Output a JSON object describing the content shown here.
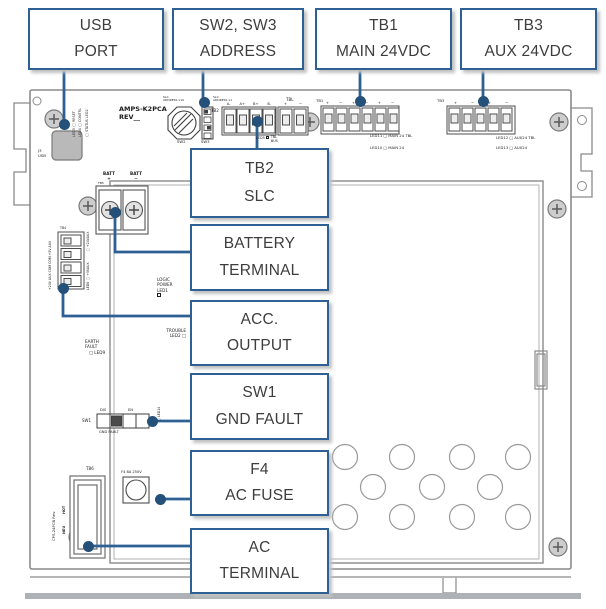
{
  "colors": {
    "accent": "#2E6094",
    "leader_dot": "#24507A",
    "line_gray": "#8A8A8A",
    "callout_text": "#3D3D3D"
  },
  "callouts": {
    "usb": {
      "line1": "USB",
      "line2": "PORT"
    },
    "sw23": {
      "line1": "SW2, SW3",
      "line2": "ADDRESS"
    },
    "tb1": {
      "line1": "TB1",
      "line2": "MAIN 24VDC"
    },
    "tb3": {
      "line1": "TB3",
      "line2": "AUX 24VDC"
    },
    "tb2": {
      "line1": "TB2",
      "line2": "SLC"
    },
    "battery": {
      "line1": "BATTERY",
      "line2": "TERMINAL"
    },
    "acc": {
      "line1": "ACC.",
      "line2": "OUTPUT"
    },
    "sw1": {
      "line1": "SW1",
      "line2": "GND FAULT"
    },
    "f4": {
      "line1": "F4",
      "line2": "AC FUSE"
    },
    "ac": {
      "line1": "AC",
      "line2": "TERMINAL"
    }
  },
  "board": {
    "title": {
      "name": "AMPS-K2PCA",
      "rev": "REV__"
    },
    "leds_top": [
      "LED3 □ RESET",
      "LED4 □ CONTRL",
      "□ STATUS LED2"
    ],
    "usb": {
      "ref": "J3",
      "label": "USB"
    },
    "sw2": {
      "label": "SW2",
      "c1": "SLC",
      "c2": "ADDRESS x10"
    },
    "sw3": {
      "label": "SW3",
      "c1": "SLC",
      "c2": "ADDRESS x1"
    },
    "tb2": {
      "ref": "TB2",
      "letters": [
        "A-",
        "A+",
        "B+",
        "B-"
      ]
    },
    "tbl": {
      "ref": "TBL",
      "marks": [
        "+",
        "−"
      ],
      "led": {
        "name": "LED5",
        "l1": "TBL",
        "l2": "BUS"
      }
    },
    "tb1": {
      "ref": "TB1",
      "marks": [
        "+",
        "−",
        "+",
        "−",
        "+",
        "−"
      ],
      "leds": [
        "LED11 □ MAIN 24 TBL",
        "LED10 □ MAIN 24"
      ]
    },
    "tb3": {
      "ref": "TB3",
      "marks": [
        "+",
        "−",
        "+",
        "−"
      ],
      "leds": [
        "LED12 □ AUX24 TBL",
        "LED13 □ AUX24"
      ]
    },
    "battery": {
      "ref": "TB5",
      "pos": "BATT",
      "pos_sign": "+",
      "neg": "BATT",
      "neg_sign": "−"
    },
    "acc": {
      "ref": "TB4",
      "pins": "+24V AUX COM COM +5V AUX",
      "led_top": "□ +24VAUX",
      "led_bottom": "LED6 □ +5VAUX"
    },
    "logic": {
      "l1": "LOGIC",
      "l2": "POWER",
      "l3": "LED1"
    },
    "trouble": {
      "l1": "TROUBLE",
      "l2": "LED2 □"
    },
    "earth": {
      "l1": "EARTH",
      "l2": "FAULT",
      "l3": "□ LED9"
    },
    "sw1": {
      "label": "SW1",
      "dis": "DIS",
      "en": "EN",
      "caption": "GND FAULT",
      "led": "□ LED14"
    },
    "f4": {
      "label": "F4 8A 250V"
    },
    "ac": {
      "ref": "TB6",
      "hot": "HOT",
      "neu": "NEU",
      "pcb": "CPS-24PCB Rev."
    }
  }
}
